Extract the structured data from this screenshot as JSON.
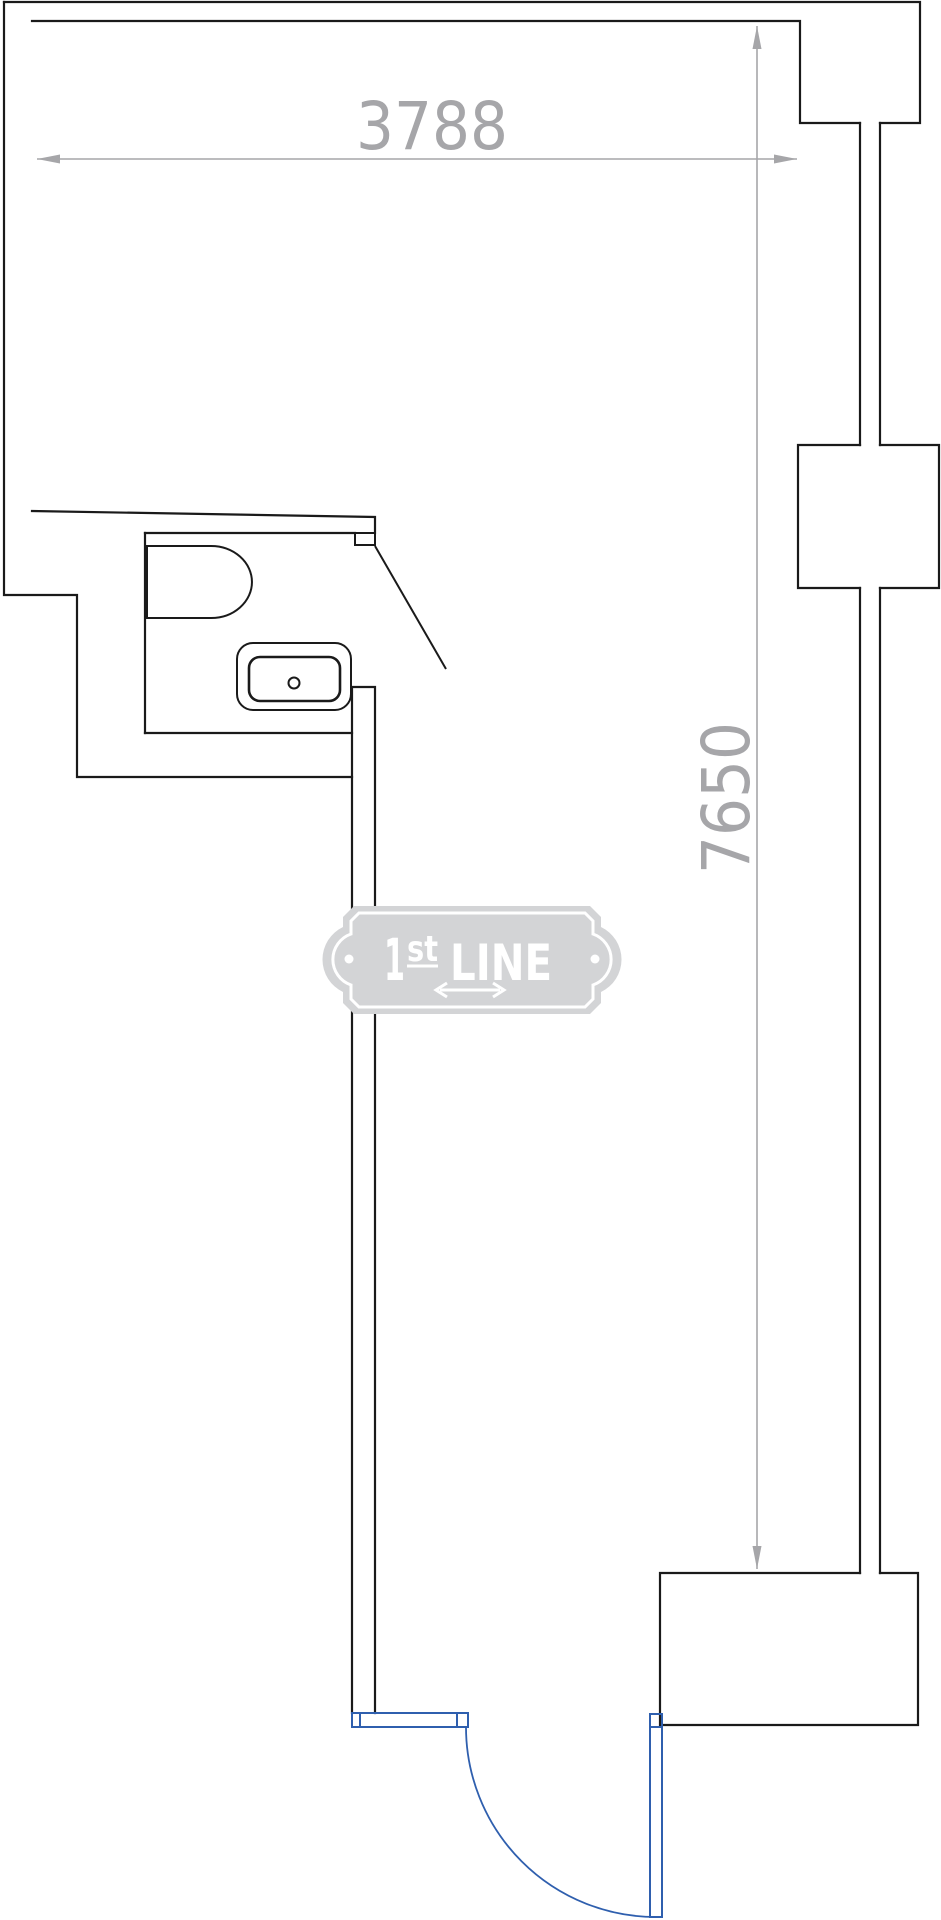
{
  "floorplan": {
    "dimensions": {
      "horizontal_label": "3788",
      "vertical_label": "7650"
    },
    "watermark": {
      "text_main": "1",
      "text_sup": "st",
      "text_rest": "LINE"
    },
    "colors": {
      "wall": "#1a1a1a",
      "dimension_gray": "#a6a6a9",
      "door_blue": "#2f5fae",
      "badge_gray": "#d3d4d6",
      "background": "#ffffff"
    }
  }
}
